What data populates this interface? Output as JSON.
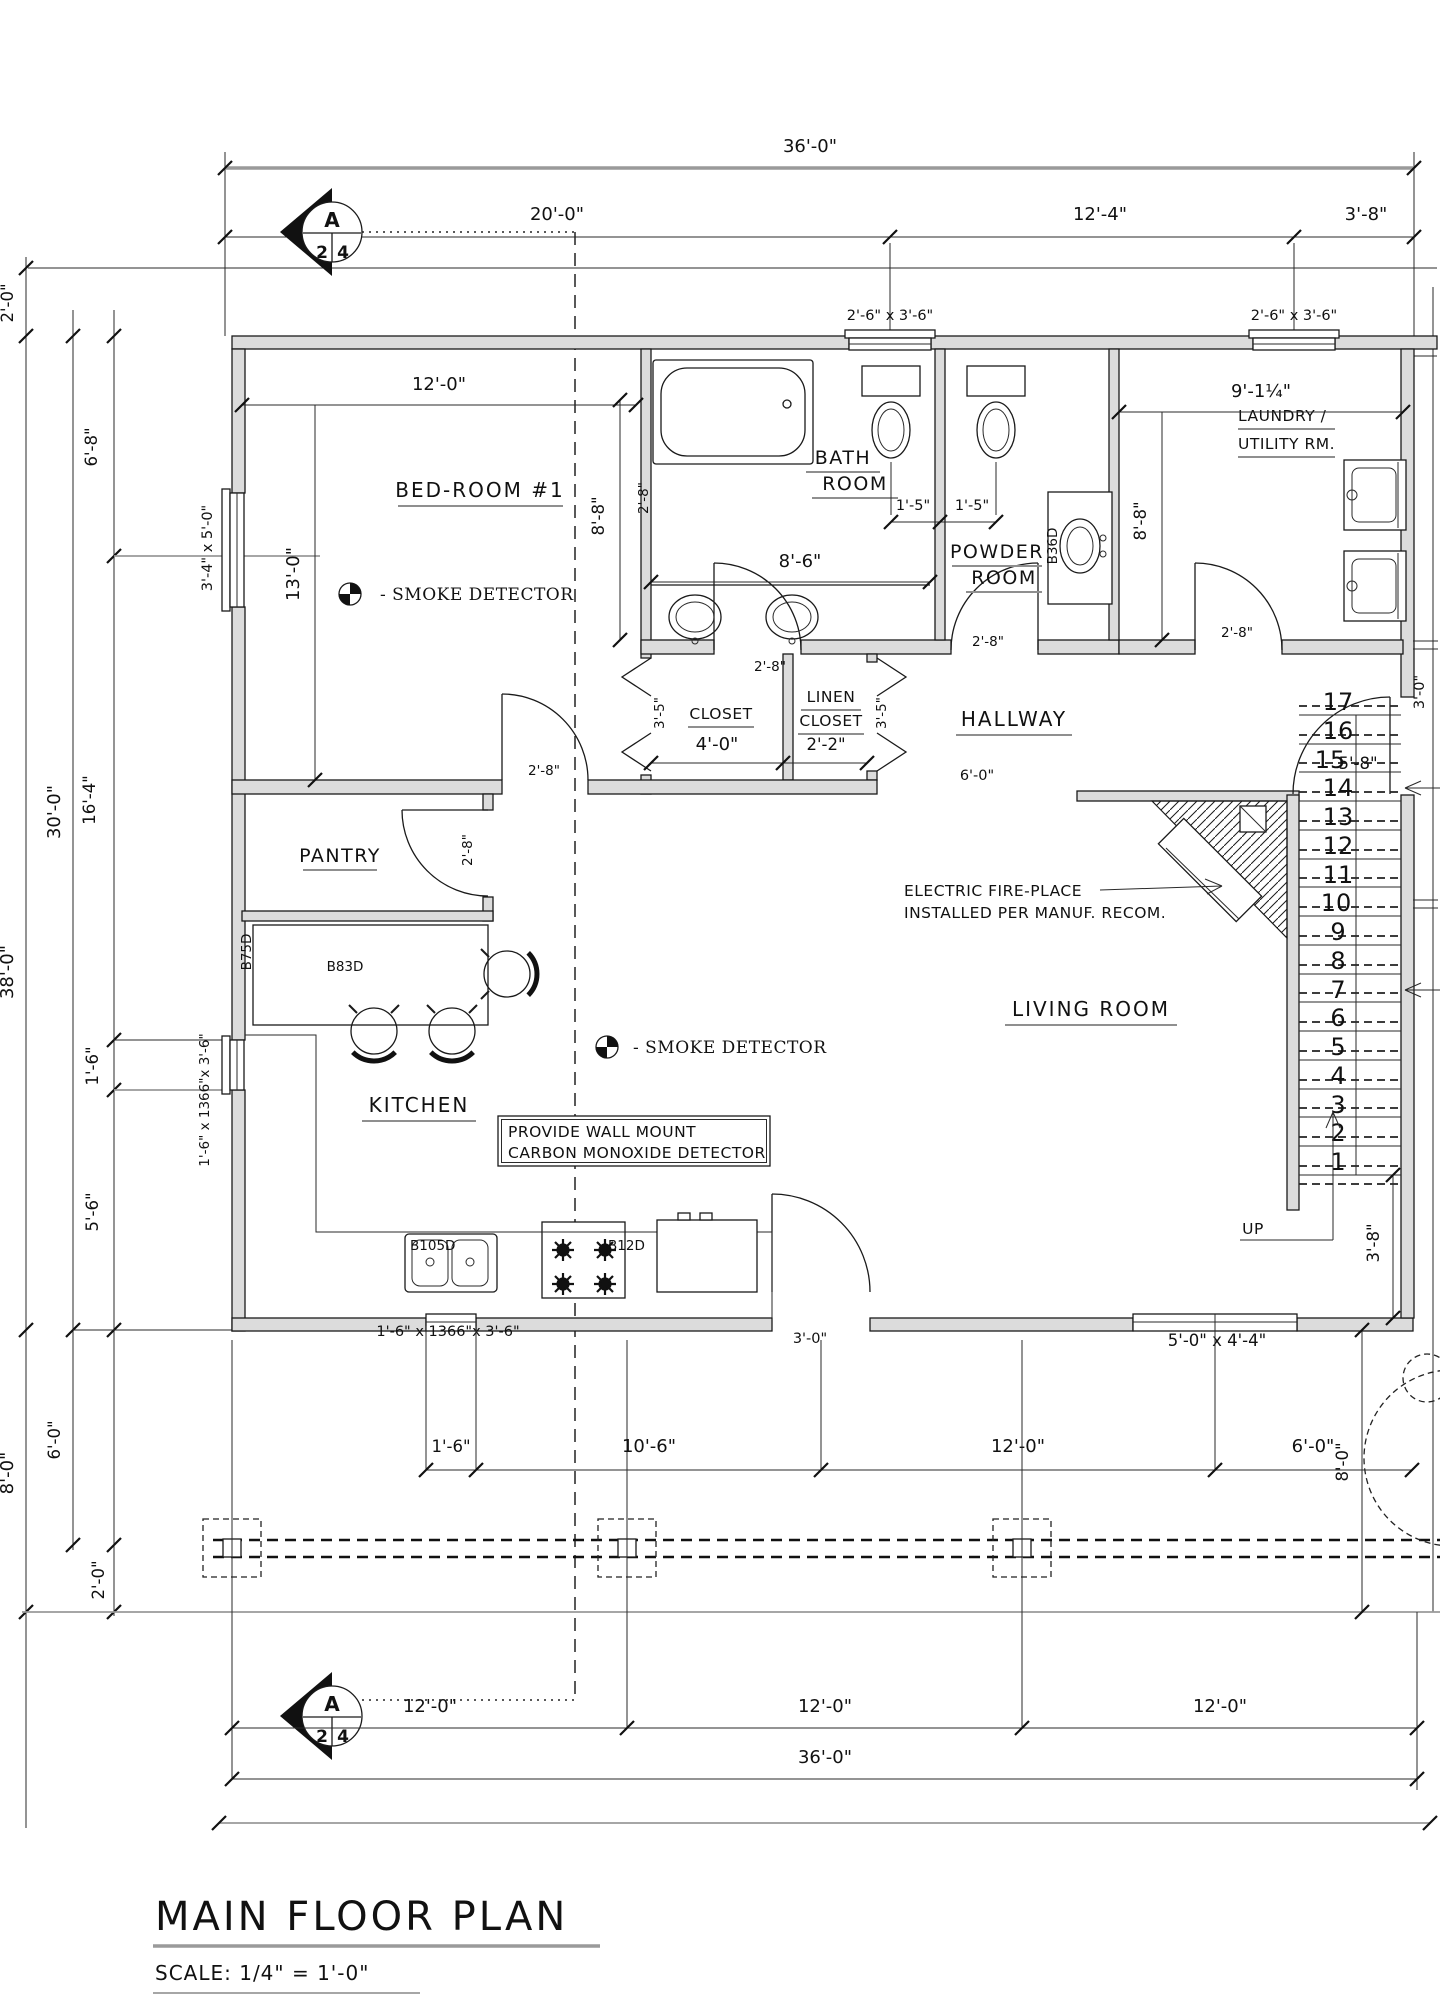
{
  "title": {
    "main": "MAIN FLOOR PLAN",
    "scale": "SCALE: 1/4\" = 1'-0\""
  },
  "marker": {
    "letter": "A",
    "n1": "2",
    "n2": "4"
  },
  "rooms": {
    "bedroom": "BED-ROOM #1",
    "bath1": "BATH",
    "bath2": "ROOM",
    "powder1": "POWDER",
    "powder2": "ROOM",
    "laundry1": "LAUNDRY /",
    "laundry2": "UTILITY RM.",
    "closet": "CLOSET",
    "linen1": "LINEN",
    "linen2": "CLOSET",
    "hallway": "HALLWAY",
    "pantry": "PANTRY",
    "kitchen": "KITCHEN",
    "living": "LIVING ROOM"
  },
  "notes": {
    "smoke": "- SMOKE DETECTOR",
    "co1": "PROVIDE WALL MOUNT",
    "co2": "CARBON MONOXIDE DETECTOR",
    "fire1": "ELECTRIC FIRE-PLACE",
    "fire2": "INSTALLED PER MANUF. RECOM.",
    "up": "UP"
  },
  "cab": {
    "b83d": "B83D",
    "b105d": "B105D",
    "b12d": "B12D",
    "b36d": "B36D",
    "b75d": "B75D"
  },
  "win": {
    "top": "2'-6\" x 3'-6\"",
    "bedroom": "3'-4\" x 5'-0\"",
    "kitchen": "1'-6\" x 1366\"x 3'-6\"",
    "living": "5'-0\" x 4'-4\""
  },
  "dims": {
    "d36_0": "36'-0\"",
    "d20_0": "20'-0\"",
    "d12_4": "12'-4\"",
    "d3_8": "3'-8\"",
    "d2_0": "2'-0\"",
    "d6_8": "6'-8\"",
    "d13_0": "13'-0\"",
    "d16_4": "16'-4\"",
    "d30_0": "30'-0\"",
    "d38_0": "38'-0\"",
    "d1_6": "1'-6\"",
    "d5_6": "5'-6\"",
    "d8_0": "8'-0\"",
    "d6_0": "6'-0\"",
    "d12_0": "12'-0\"",
    "d8_8": "8'-8\"",
    "d8_6": "8'-6\"",
    "d1_5": "1'-5\"",
    "d9_1": "9'-1¼\"",
    "d4_0": "4'-0\"",
    "d2_2": "2'-2\"",
    "d3_5": "3'-5\"",
    "d2_8": "2'-8\"",
    "d3_0": "3'-0\"",
    "d5_8": "5'-8\"",
    "d10_6": "10'-6\""
  },
  "stairs": {
    "n1": "1",
    "n2": "2",
    "n3": "3",
    "n4": "4",
    "n5": "5",
    "n6": "6",
    "n7": "7",
    "n8": "8",
    "n9": "9",
    "n10": "10",
    "n11": "11",
    "n12": "12",
    "n13": "13",
    "n14": "14",
    "n15": "15",
    "n16": "16",
    "n17": "17"
  },
  "colors": {
    "ink": "#111111",
    "wall_fill": "#dcdcdc",
    "gray_line": "#9a9a9a"
  }
}
